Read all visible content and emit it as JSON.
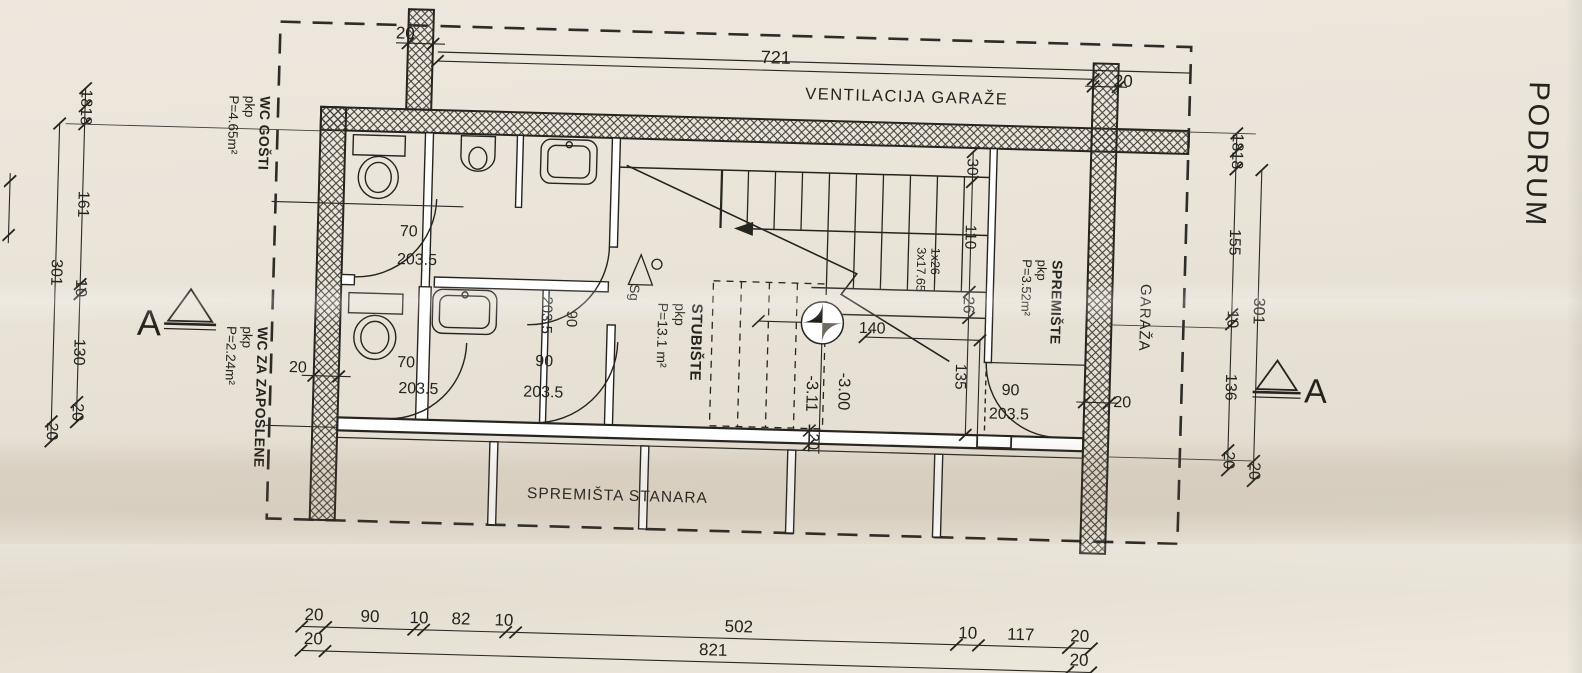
{
  "title": {
    "text": "PODRUM"
  },
  "rooms": {
    "wc_gosti": {
      "name": "WC GOŠTI",
      "finish": "pkp",
      "area": "P=4.65m²"
    },
    "wc_zaposleni": {
      "name": "WC ZA ZAPOSLENE",
      "finish": "pkp",
      "area": "P=2.24m²"
    },
    "stubiste": {
      "name": "STUBIŠTE",
      "finish": "pkp",
      "area": "P=13.1 m²"
    },
    "spremiste": {
      "name": "SPREMIŠTE",
      "finish": "pkp",
      "area": "P=3.52m²"
    },
    "garaza": {
      "name": "GARAŽA"
    },
    "ventilacija": {
      "name": "VENTILACIJA GARAŽE"
    },
    "spremista_stanara": {
      "name": "SPREMIŠTA STANARA"
    }
  },
  "stairs": {
    "treads": "1x26",
    "risers": "3x17.65",
    "drain": "Sg"
  },
  "levels": {
    "floor": "-3.00",
    "lower": "-3.11"
  },
  "section": {
    "left": "A",
    "right": "A"
  },
  "dims": {
    "top": {
      "col": "20",
      "span": "721",
      "wall": "20"
    },
    "left": {
      "segs": [
        "18",
        "18",
        "161",
        "10",
        "130",
        "20"
      ],
      "total": "301",
      "total2": "20"
    },
    "right": {
      "segs": [
        "18",
        "18",
        "155",
        "10",
        "136",
        "20"
      ],
      "total": "301",
      "total2": "20"
    },
    "bottom1": [
      "20",
      "90",
      "10",
      "82",
      "10",
      "502",
      "10",
      "117",
      "20"
    ],
    "bottom2": [
      "20",
      "821",
      "20"
    ],
    "stair_chain": [
      "30",
      "110",
      "26",
      "135"
    ],
    "landing": "140",
    "wall_left": "20",
    "wall_right": "20",
    "wall_bottom": "20",
    "doors": {
      "d1": {
        "w": "70",
        "h": "203.5"
      },
      "d2": {
        "w": "90",
        "h": "203.5"
      },
      "d3": {
        "w": "70",
        "h": "203.5"
      },
      "d4": {
        "w": "90",
        "h": "203.5"
      },
      "d5": {
        "w": "90",
        "h": "203.5"
      }
    }
  }
}
